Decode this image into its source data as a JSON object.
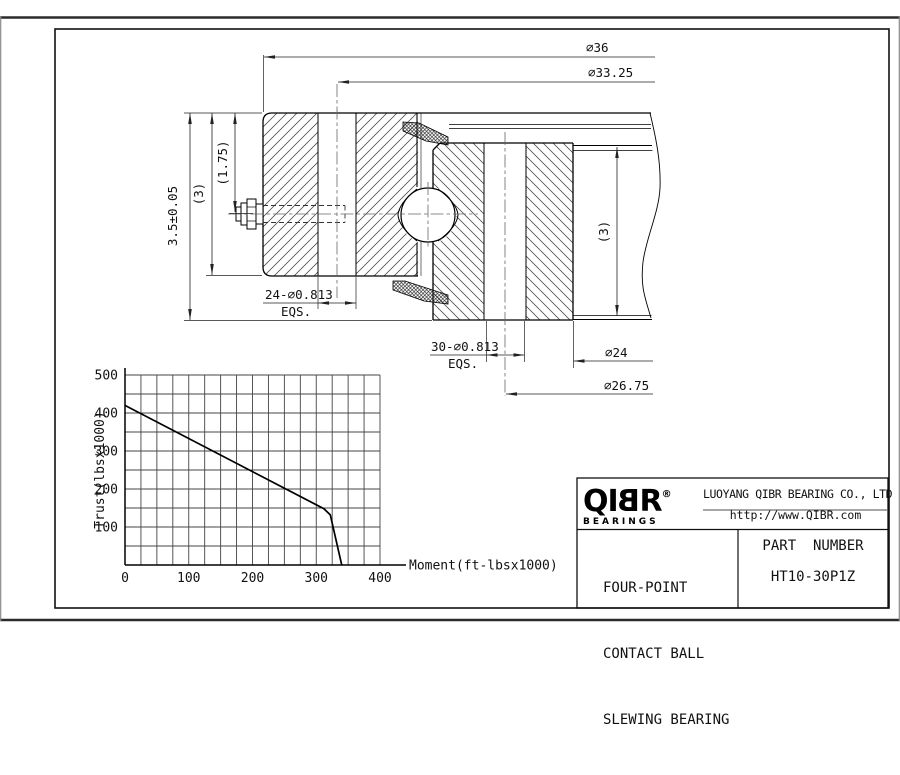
{
  "title_block": {
    "logo_prefix": "QI",
    "logo_b": "B",
    "logo_suffix": "R",
    "registered": "®",
    "logo_sub": "BEARINGS",
    "company": "LUOYANG QIBR BEARING CO., LTD",
    "website": "http://www.QIBR.com",
    "product_line1": "FOUR-POINT",
    "product_line2": "CONTACT BALL",
    "product_line3": "SLEWING BEARING",
    "part_label": "PART  NUMBER",
    "part_number": "HT10-30P1Z"
  },
  "drawing": {
    "dims": {
      "outer_diameter": "⌀36",
      "outer_bolt_circle": "⌀33.25",
      "overall_height": "3.5±0.05",
      "left_ring_height": "(3)",
      "grease_fitting_height": "(1.75)",
      "outer_holes": "24-⌀0.813",
      "outer_holes_note": "EQS.",
      "inner_holes": "30-⌀0.813",
      "inner_holes_note": "EQS.",
      "inner_diameter": "⌀24",
      "inner_bolt_circle": "⌀26.75",
      "right_ring_height": "(3)"
    }
  },
  "chart_data": {
    "type": "line",
    "title": "",
    "xlabel": "Moment(ft-lbsx1000)",
    "ylabel": "Trust(lbsx1000)",
    "xlim": [
      0,
      400
    ],
    "ylim": [
      0,
      500
    ],
    "x_tick_labels": [
      0,
      100,
      200,
      300,
      400
    ],
    "y_tick_labels": [
      100,
      200,
      300,
      400,
      500
    ],
    "x_grid_step": 25,
    "y_grid_step": 50,
    "grid": true,
    "legend": "none",
    "grid_color": "#444444",
    "line_color": "#000000",
    "series": [
      {
        "name": "allowable-thrust-vs-moment",
        "points": [
          [
            0,
            420
          ],
          [
            312,
            148
          ],
          [
            322,
            132
          ],
          [
            340,
            0
          ]
        ]
      }
    ]
  }
}
